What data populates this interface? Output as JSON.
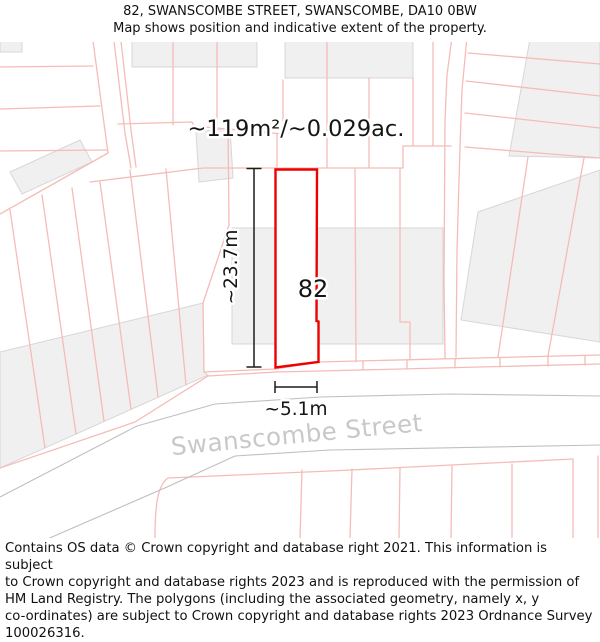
{
  "title": {
    "line1": "82, SWANSCOMBE STREET, SWANSCOMBE, DA10 0BW",
    "line2": "Map shows position and indicative extent of the property."
  },
  "map": {
    "area_label": "~119m²/~0.029ac.",
    "plot_number": "82",
    "height_label": "~23.7m",
    "width_label": "~5.1m",
    "street_name": "Swanscombe Street",
    "colors": {
      "plot_outline": "#ee0000",
      "parcel_line": "#f5bcb6",
      "building_fill": "#f1f0f1",
      "building_stroke": "#d8d6d6",
      "road_edge": "#c0bfbf",
      "street_text": "#c8c8c8",
      "dimension": "#1c1c1c"
    }
  },
  "footer": {
    "lines": [
      "Contains OS data © Crown copyright and database right 2021. This information is subject",
      "to Crown copyright and database rights 2023 and is reproduced with the permission of",
      "HM Land Registry. The polygons (including the associated geometry, namely x, y",
      "co-ordinates) are subject to Crown copyright and database rights 2023 Ordnance Survey",
      "100026316."
    ]
  }
}
